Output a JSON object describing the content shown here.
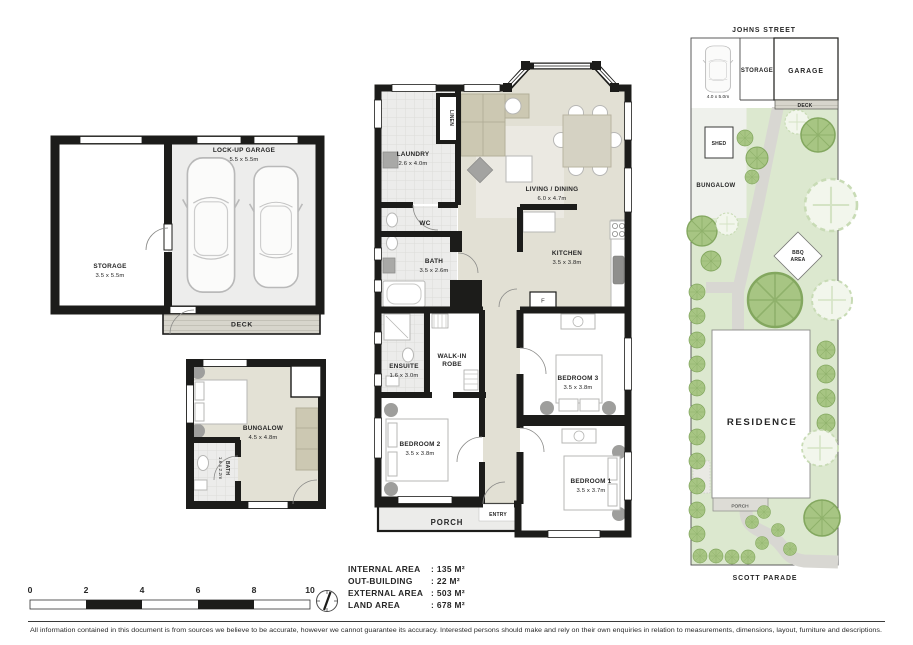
{
  "garage_plan": {
    "storage_name": "STORAGE",
    "storage_dims": "3.5 x 5.5m",
    "garage_name": "LOCK-UP GARAGE",
    "garage_dims": "5.5 x 5.5m",
    "deck_label": "DECK"
  },
  "bungalow_plan": {
    "name": "BUNGALOW",
    "dims": "4.5 x 4.8m",
    "bath_name": "BATH",
    "bath_dims": "1.6 x 2.2m"
  },
  "main_plan": {
    "laundry_name": "LAUNDRY",
    "laundry_dims": "2.6 x 4.0m",
    "linen": "LINEN",
    "living_name": "LIVING / DINING",
    "living_dims": "6.0 x 4.7m",
    "wc": "WC",
    "bath_name": "BATH",
    "bath_dims": "3.5 x 2.6m",
    "kitchen_name": "KITCHEN",
    "kitchen_dims": "3.5 x 3.8m",
    "fridge": "F",
    "ensuite_name": "ENSUITE",
    "ensuite_dims": "1.6 x 3.0m",
    "robe_line1": "WALK-IN",
    "robe_line2": "ROBE",
    "bedroom3_name": "BEDROOM 3",
    "bedroom3_dims": "3.5 x 3.8m",
    "bedroom2_name": "BEDROOM 2",
    "bedroom2_dims": "3.5 x 3.8m",
    "bedroom1_name": "BEDROOM 1",
    "bedroom1_dims": "3.5 x 3.7m",
    "entry": "ENTRY",
    "porch": "PORCH"
  },
  "site_plan": {
    "street_top": "JOHNS STREET",
    "street_bottom": "SCOTT PARADE",
    "parking_dims": "4.0 x 5.0m",
    "storage": "STORAGE",
    "garage": "GARAGE",
    "deck": "DECK",
    "shed": "SHED",
    "bungalow": "BUNGALOW",
    "bbq_line1": "BBQ",
    "bbq_line2": "AREA",
    "residence": "RESIDENCE",
    "porch": "PORCH"
  },
  "scale_bar": {
    "ticks": [
      "0",
      "2",
      "4",
      "6",
      "8",
      "10"
    ]
  },
  "area_summary": {
    "rows": [
      {
        "label": "INTERNAL AREA",
        "value": ": 135 M²"
      },
      {
        "label": "OUT-BUILDING",
        "value": ": 22 M²"
      },
      {
        "label": "EXTERNAL AREA",
        "value": ": 503 M²"
      },
      {
        "label": "LAND AREA",
        "value": ": 678 M²"
      }
    ]
  },
  "disclaimer": "All information contained in this document is from sources we believe to be accurate, however we cannot guarantee its accuracy. Interested persons should make and rely on their own enquiries in relation to measurements, dimensions, layout, furniture and descriptions.",
  "colors": {
    "wall": "#1c1c1a",
    "floor_beige": "#e2e0d4",
    "floor_tile": "#ececeb",
    "garden_green": "#dce8cf",
    "tree_green": "#a7c583",
    "path_grey": "#d8d7d2"
  }
}
